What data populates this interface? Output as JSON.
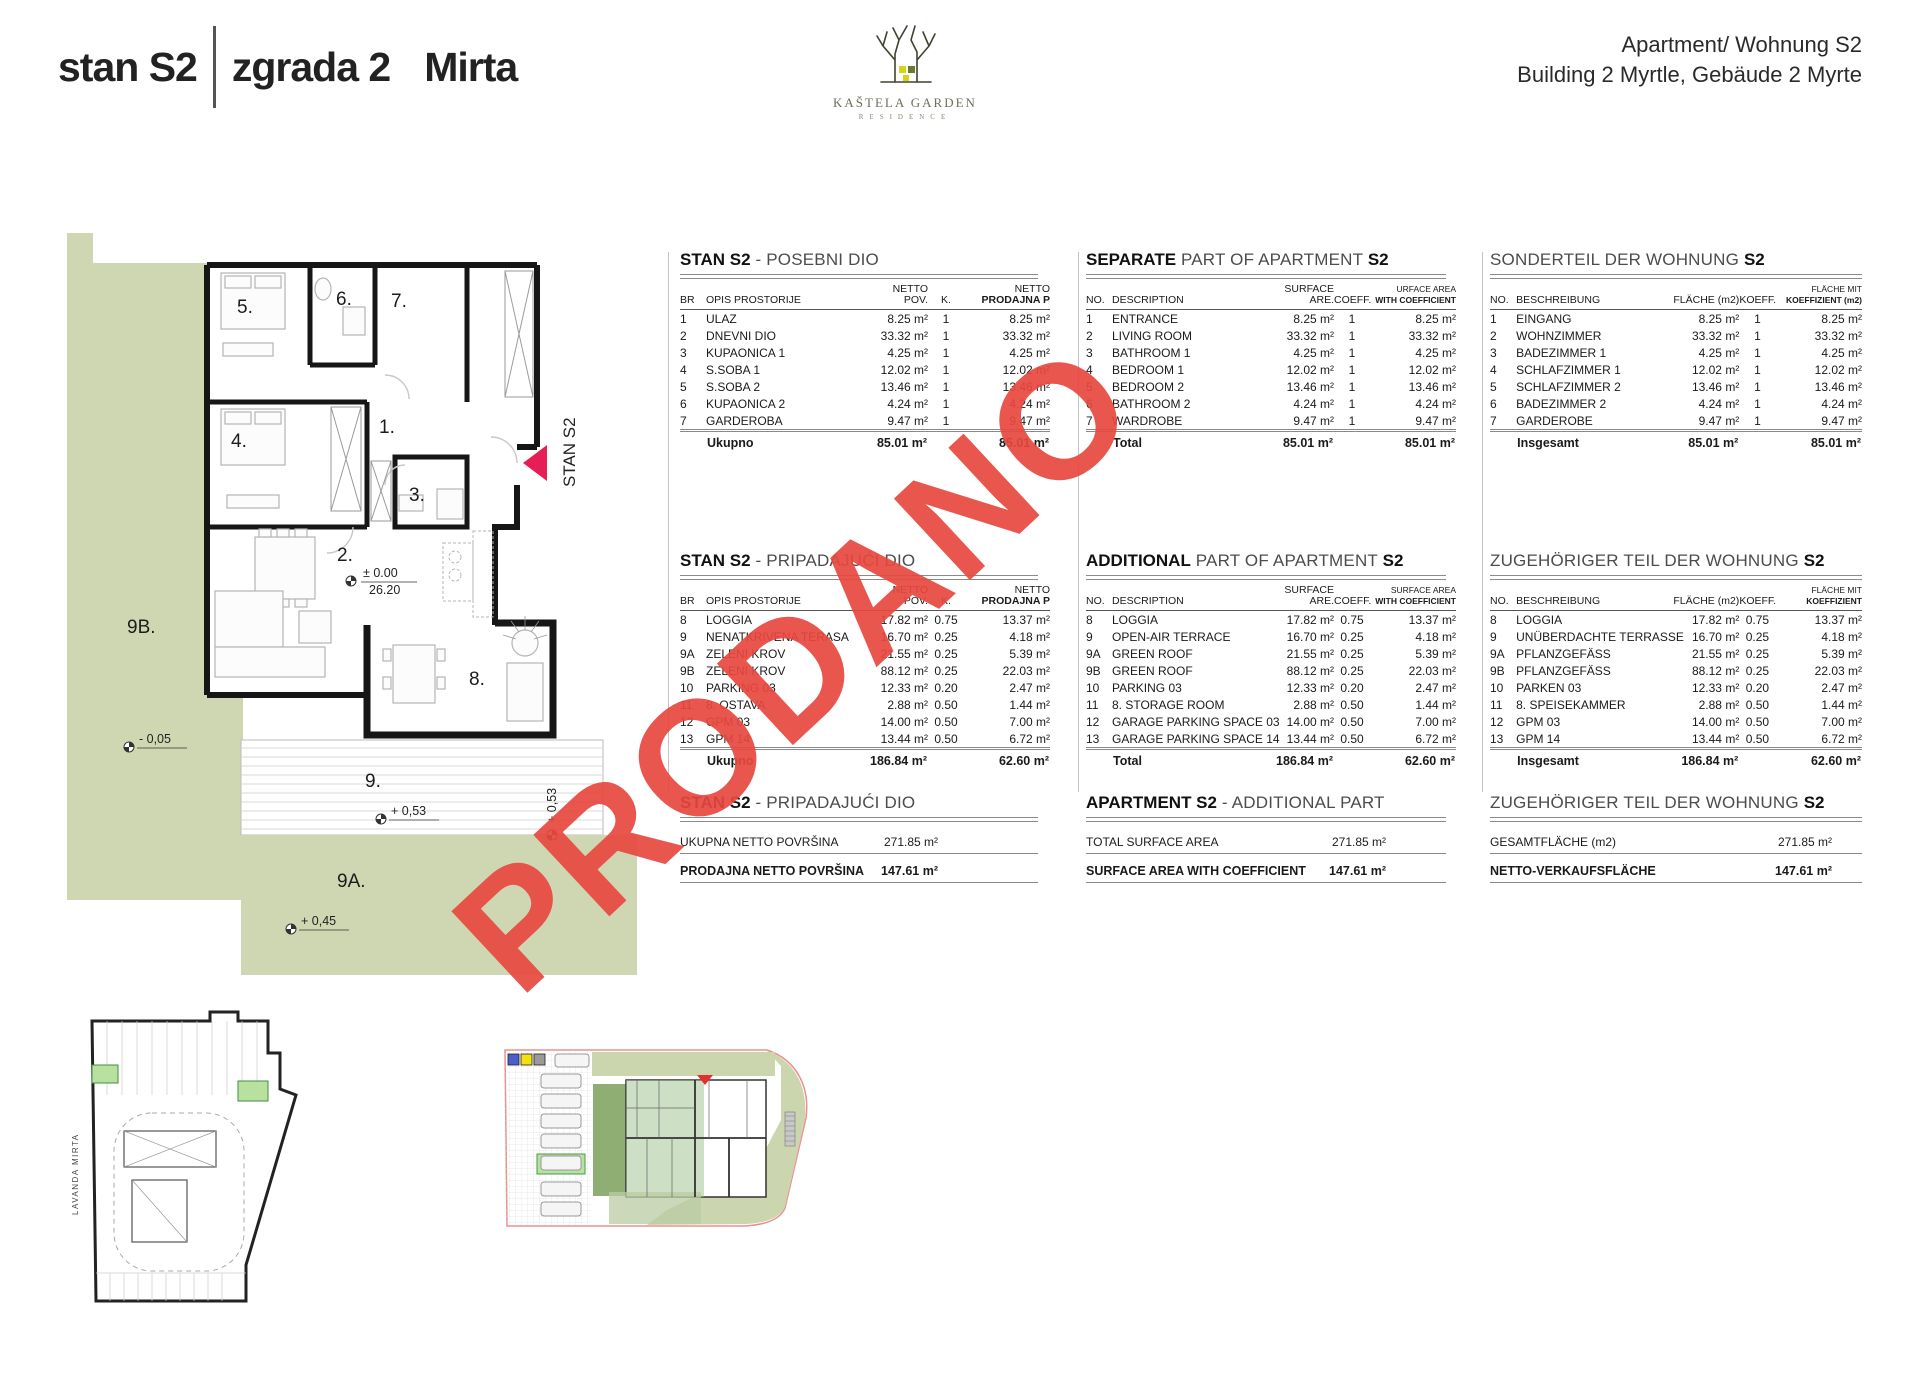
{
  "header": {
    "title_unit": "stan S2",
    "title_building": "zgrada 2",
    "title_name": "Mirta",
    "right_line1": "Apartment/ Wohnung S2",
    "right_line2": "Building 2 Myrtle, Gebäude 2 Myrte",
    "logo_line1": "KAŠTELA GARDEN",
    "logo_line2": "RESIDENCE"
  },
  "stamp": {
    "text": "PRODANO",
    "color": "#e84840"
  },
  "colors": {
    "plan_green": "#cfd7b2",
    "stall_green": "#b8e09e",
    "marker_pink": "#e61e56",
    "stamp_red": "#e84840",
    "legend_blue": "#4a5fc8",
    "legend_yellow": "#f2e10c",
    "legend_gray": "#9a9a9a"
  },
  "floor_plan": {
    "unit_label": "STAN S2",
    "rooms": {
      "r1": "1.",
      "r2": "2.",
      "r3": "3.",
      "r4": "4.",
      "r5": "5.",
      "r6": "6.",
      "r7": "7.",
      "r8": "8.",
      "r9": "9.",
      "r9a": "9A.",
      "r9b": "9B."
    },
    "levels": {
      "zero": "± 0.00",
      "abs": "26.20",
      "minus05": "- 0,05",
      "plus053": "+ 0,53",
      "plus045": "+ 0,45",
      "plus053v": "+ 0,53"
    }
  },
  "garage_plan": {
    "street_label": "LAVANDA   MIRTA"
  },
  "columns": [
    {
      "id": "hr",
      "t1": {
        "title_a": "STAN S2",
        "title_b": " - POSEBNI DIO",
        "title_c": "",
        "h_no": "BR",
        "h_desc": "OPIS PROSTORIJE",
        "h_area1": "NETTO",
        "h_area2": "POV.",
        "h_k": "K.",
        "h_sale1": "NETTO",
        "h_sale2": "PRODAJNA P",
        "rows": [
          {
            "no": "1",
            "desc": "ULAZ",
            "area": "8.25 m²",
            "k": "1",
            "sale": "8.25 m²"
          },
          {
            "no": "2",
            "desc": "DNEVNI DIO",
            "area": "33.32 m²",
            "k": "1",
            "sale": "33.32 m²"
          },
          {
            "no": "3",
            "desc": "KUPAONICA 1",
            "area": "4.25 m²",
            "k": "1",
            "sale": "4.25 m²"
          },
          {
            "no": "4",
            "desc": "S.SOBA 1",
            "area": "12.02 m²",
            "k": "1",
            "sale": "12.02 m²"
          },
          {
            "no": "5",
            "desc": "S.SOBA 2",
            "area": "13.46 m²",
            "k": "1",
            "sale": "13.46 m²"
          },
          {
            "no": "6",
            "desc": "KUPAONICA 2",
            "area": "4.24 m²",
            "k": "1",
            "sale": "4.24 m²"
          },
          {
            "no": "7",
            "desc": "GARDEROBA",
            "area": "9.47 m²",
            "k": "1",
            "sale": "9.47 m²"
          }
        ],
        "total_label": "Ukupno",
        "total_area": "85.01 m²",
        "total_sale": "85.01 m²"
      },
      "t2": {
        "title_a": "STAN S2",
        "title_b": " - PRIPADAJUĆI DIO",
        "title_c": "",
        "h_no": "BR",
        "h_desc": "OPIS PROSTORIJE",
        "h_area1": "NETTO",
        "h_area2": "POV.",
        "h_k": "K.",
        "h_sale1": "NETTO",
        "h_sale2": "PRODAJNA P",
        "rows": [
          {
            "no": "8",
            "desc": "LOGGIA",
            "area": "17.82 m²",
            "k": "0.75",
            "sale": "13.37 m²"
          },
          {
            "no": "9",
            "desc": "NENATKRIVENA TERASA",
            "area": "16.70 m²",
            "k": "0.25",
            "sale": "4.18 m²"
          },
          {
            "no": "9A",
            "desc": "ZELENI KROV",
            "area": "21.55 m²",
            "k": "0.25",
            "sale": "5.39 m²"
          },
          {
            "no": "9B",
            "desc": "ZELENI KROV",
            "area": "88.12 m²",
            "k": "0.25",
            "sale": "22.03 m²"
          },
          {
            "no": "10",
            "desc": "PARKING 03",
            "area": "12.33 m²",
            "k": "0.20",
            "sale": "2.47 m²"
          },
          {
            "no": "11",
            "desc": "8. OSTAVA",
            "area": "2.88 m²",
            "k": "0.50",
            "sale": "1.44 m²"
          },
          {
            "no": "12",
            "desc": "GPM 03",
            "area": "14.00 m²",
            "k": "0.50",
            "sale": "7.00 m²"
          },
          {
            "no": "13",
            "desc": "GPM 14",
            "area": "13.44 m²",
            "k": "0.50",
            "sale": "6.72 m²"
          }
        ],
        "total_label": "Ukupno",
        "total_area": "186.84 m²",
        "total_sale": "62.60 m²"
      },
      "summary": {
        "title_a": "STAN S2",
        "title_b": " - PRIPADAJUĆI DIO",
        "title_c": "",
        "row1_label": "UKUPNA NETTO POVRŠINA",
        "row1_value": "271.85 m²",
        "row2_label": "PRODAJNA NETTO POVRŠINA",
        "row2_value": "147.61 m²"
      }
    },
    {
      "id": "en",
      "t1": {
        "title_a": "SEPARATE",
        "title_b": " PART OF APARTMENT ",
        "title_c": "S2",
        "h_no": "NO.",
        "h_desc": "DESCRIPTION",
        "h_area1": "SURFACE",
        "h_area2": "ARE.",
        "h_k": "COEFF.",
        "h_sale1": "URFACE AREA",
        "h_sale2": "WITH COEFFICIENT",
        "rows": [
          {
            "no": "1",
            "desc": "ENTRANCE",
            "area": "8.25 m²",
            "k": "1",
            "sale": "8.25 m²"
          },
          {
            "no": "2",
            "desc": "LIVING ROOM",
            "area": "33.32 m²",
            "k": "1",
            "sale": "33.32 m²"
          },
          {
            "no": "3",
            "desc": "BATHROOM 1",
            "area": "4.25 m²",
            "k": "1",
            "sale": "4.25 m²"
          },
          {
            "no": "4",
            "desc": "BEDROOM 1",
            "area": "12.02 m²",
            "k": "1",
            "sale": "12.02 m²"
          },
          {
            "no": "5",
            "desc": "BEDROOM 2",
            "area": "13.46 m²",
            "k": "1",
            "sale": "13.46 m²"
          },
          {
            "no": "6",
            "desc": "BATHROOM 2",
            "area": "4.24 m²",
            "k": "1",
            "sale": "4.24 m²"
          },
          {
            "no": "7",
            "desc": "WARDROBE",
            "area": "9.47 m²",
            "k": "1",
            "sale": "9.47 m²"
          }
        ],
        "total_label": "Total",
        "total_area": "85.01 m²",
        "total_sale": "85.01 m²"
      },
      "t2": {
        "title_a": "ADDITIONAL",
        "title_b": " PART OF APARTMENT ",
        "title_c": "S2",
        "h_no": "NO.",
        "h_desc": "DESCRIPTION",
        "h_area1": "SURFACE",
        "h_area2": "ARE.",
        "h_k": "COEFF.",
        "h_sale1": "SURFACE AREA",
        "h_sale2": "WITH COEFFICIENT",
        "rows": [
          {
            "no": "8",
            "desc": "LOGGIA",
            "area": "17.82 m²",
            "k": "0.75",
            "sale": "13.37 m²"
          },
          {
            "no": "9",
            "desc": "OPEN-AIR TERRACE",
            "area": "16.70 m²",
            "k": "0.25",
            "sale": "4.18 m²"
          },
          {
            "no": "9A",
            "desc": "GREEN ROOF",
            "area": "21.55 m²",
            "k": "0.25",
            "sale": "5.39 m²"
          },
          {
            "no": "9B",
            "desc": "GREEN ROOF",
            "area": "88.12 m²",
            "k": "0.25",
            "sale": "22.03 m²"
          },
          {
            "no": "10",
            "desc": "PARKING 03",
            "area": "12.33 m²",
            "k": "0.20",
            "sale": "2.47 m²"
          },
          {
            "no": "11",
            "desc": "8. STORAGE ROOM",
            "area": "2.88 m²",
            "k": "0.50",
            "sale": "1.44 m²"
          },
          {
            "no": "12",
            "desc": "GARAGE PARKING SPACE 03",
            "area": "14.00 m²",
            "k": "0.50",
            "sale": "7.00 m²"
          },
          {
            "no": "13",
            "desc": "GARAGE PARKING SPACE 14",
            "area": "13.44 m²",
            "k": "0.50",
            "sale": "6.72 m²"
          }
        ],
        "total_label": "Total",
        "total_area": "186.84 m²",
        "total_sale": "62.60 m²"
      },
      "summary": {
        "title_a": "APARTMENT S2",
        "title_b": " - ADDITIONAL PART",
        "title_c": "",
        "row1_label": "TOTAL SURFACE AREA",
        "row1_value": "271.85 m²",
        "row2_label": "SURFACE AREA WITH COEFFICIENT",
        "row2_value": "147.61 m²"
      }
    },
    {
      "id": "de",
      "t1": {
        "title_a": "",
        "title_b": "SONDERTEIL DER WOHNUNG ",
        "title_c": "S2",
        "h_no": "NO.",
        "h_desc": "BESCHREIBUNG",
        "h_area1": "",
        "h_area2": "FLÄCHE (m2)",
        "h_k": "KOEFF.",
        "h_sale1": "FLÄCHE MIT",
        "h_sale2": "KOEFFIZIENT (m2)",
        "rows": [
          {
            "no": "1",
            "desc": "EINGANG",
            "area": "8.25 m²",
            "k": "1",
            "sale": "8.25 m²"
          },
          {
            "no": "2",
            "desc": "WOHNZIMMER",
            "area": "33.32 m²",
            "k": "1",
            "sale": "33.32 m²"
          },
          {
            "no": "3",
            "desc": "BADEZIMMER 1",
            "area": "4.25 m²",
            "k": "1",
            "sale": "4.25 m²"
          },
          {
            "no": "4",
            "desc": "SCHLAFZIMMER 1",
            "area": "12.02 m²",
            "k": "1",
            "sale": "12.02 m²"
          },
          {
            "no": "5",
            "desc": "SCHLAFZIMMER 2",
            "area": "13.46 m²",
            "k": "1",
            "sale": "13.46 m²"
          },
          {
            "no": "6",
            "desc": "BADEZIMMER 2",
            "area": "4.24 m²",
            "k": "1",
            "sale": "4.24 m²"
          },
          {
            "no": "7",
            "desc": "GARDEROBE",
            "area": "9.47 m²",
            "k": "1",
            "sale": "9.47 m²"
          }
        ],
        "total_label": "Insgesamt",
        "total_area": "85.01 m²",
        "total_sale": "85.01 m²"
      },
      "t2": {
        "title_a": "",
        "title_b": "ZUGEHÖRIGER TEIL DER WOHNUNG ",
        "title_c": "S2",
        "h_no": "NO.",
        "h_desc": "BESCHREIBUNG",
        "h_area1": "",
        "h_area2": "FLÄCHE (m2)",
        "h_k": "KOEFF.",
        "h_sale1": "FLÄCHE MIT",
        "h_sale2": "KOEFFIZIENT",
        "rows": [
          {
            "no": "8",
            "desc": "LOGGIA",
            "area": "17.82 m²",
            "k": "0.75",
            "sale": "13.37 m²"
          },
          {
            "no": "9",
            "desc": "UNÜBERDACHTE TERRASSE",
            "area": "16.70 m²",
            "k": "0.25",
            "sale": "4.18 m²"
          },
          {
            "no": "9A",
            "desc": "PFLANZGEFÄSS",
            "area": "21.55 m²",
            "k": "0.25",
            "sale": "5.39 m²"
          },
          {
            "no": "9B",
            "desc": "PFLANZGEFÄSS",
            "area": "88.12 m²",
            "k": "0.25",
            "sale": "22.03 m²"
          },
          {
            "no": "10",
            "desc": "PARKEN 03",
            "area": "12.33 m²",
            "k": "0.20",
            "sale": "2.47 m²"
          },
          {
            "no": "11",
            "desc": "8. SPEISEKAMMER",
            "area": "2.88 m²",
            "k": "0.50",
            "sale": "1.44 m²"
          },
          {
            "no": "12",
            "desc": "GPM 03",
            "area": "14.00 m²",
            "k": "0.50",
            "sale": "7.00 m²"
          },
          {
            "no": "13",
            "desc": "GPM 14",
            "area": "13.44 m²",
            "k": "0.50",
            "sale": "6.72 m²"
          }
        ],
        "total_label": "Insgesamt",
        "total_area": "186.84 m²",
        "total_sale": "62.60 m²"
      },
      "summary": {
        "title_a": "",
        "title_b": "ZUGEHÖRIGER TEIL DER WOHNUNG ",
        "title_c": "S2",
        "row1_label": "GESAMTFLÄCHE (m2)",
        "row1_value": "271.85 m²",
        "row2_label": "NETTO-VERKAUFSFLÄCHE",
        "row2_value": "147.61 m²"
      }
    }
  ]
}
